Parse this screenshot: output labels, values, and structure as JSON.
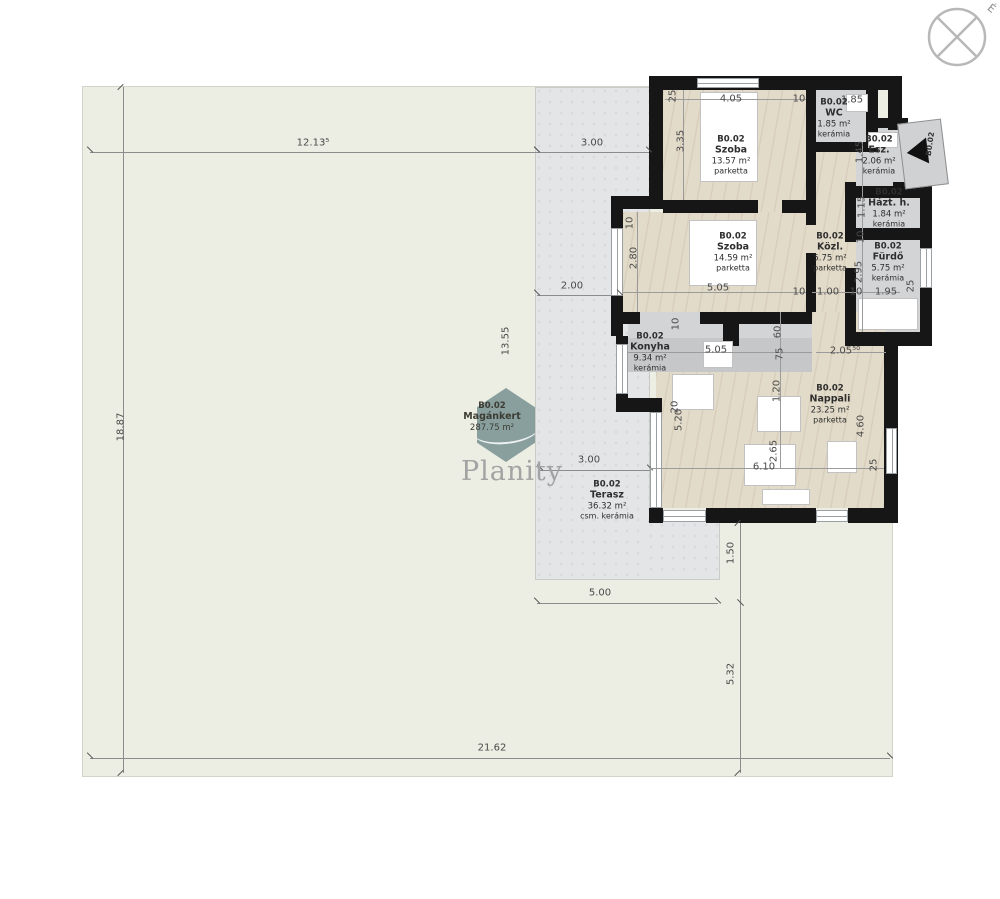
{
  "watermark": {
    "brand": "Planity"
  },
  "compass": {
    "north_label": "É"
  },
  "entrance": {
    "unit_label": "B0.02"
  },
  "colors": {
    "wall": "#161616",
    "parquet_floor": "#e3dbc9",
    "ceramic_floor": "#d3d4d6",
    "terrace": "#e4e5e7",
    "garden": "#ecede3",
    "dimension_text": "#4a4a4a",
    "watermark_hex": "#718d8f"
  },
  "rooms": [
    {
      "id": "szoba-1",
      "unit": "B0.02",
      "name": "Szoba",
      "area": "13.57 m²",
      "material": "parketta",
      "cx": 731,
      "cy": 155
    },
    {
      "id": "wc",
      "unit": "B0.02",
      "name": "WC",
      "area": "1.85 m²",
      "material": "kerámia",
      "cx": 834,
      "cy": 118
    },
    {
      "id": "eloszoba",
      "unit": "B0.02",
      "name": "Esz.",
      "area": "2.06 m²",
      "material": "kerámia",
      "cx": 879,
      "cy": 155
    },
    {
      "id": "haztartasi-helyiseg",
      "unit": "B0.02",
      "name": "Házt. h.",
      "area": "1.84 m²",
      "material": "kerámia",
      "cx": 889,
      "cy": 208
    },
    {
      "id": "furdo",
      "unit": "B0.02",
      "name": "Fürdő",
      "area": "5.75 m²",
      "material": "kerámia",
      "cx": 888,
      "cy": 262
    },
    {
      "id": "kozlekedo",
      "unit": "B0.02",
      "name": "Közl.",
      "area": "5.75 m²",
      "material": "parketta",
      "cx": 830,
      "cy": 252
    },
    {
      "id": "szoba-2",
      "unit": "B0.02",
      "name": "Szoba",
      "area": "14.59 m²",
      "material": "parketta",
      "cx": 733,
      "cy": 252
    },
    {
      "id": "konyha",
      "unit": "B0.02",
      "name": "Konyha",
      "area": "9.34 m²",
      "material": "kerámia",
      "cx": 650,
      "cy": 352
    },
    {
      "id": "nappali",
      "unit": "B0.02",
      "name": "Nappali",
      "area": "23.25 m²",
      "material": "parketta",
      "cx": 830,
      "cy": 404
    },
    {
      "id": "terasz",
      "unit": "B0.02",
      "name": "Terasz",
      "area": "36.32 m²",
      "material": "csm. kerámia",
      "cx": 607,
      "cy": 500
    },
    {
      "id": "magankert",
      "unit": "B0.02",
      "name": "Magánkert",
      "area": "287.75 m²",
      "material": "",
      "cx": 492,
      "cy": 417,
      "garden": true
    }
  ],
  "dimensions": [
    {
      "v": "12.13⁵",
      "x": 313,
      "y": 143,
      "rot": 0
    },
    {
      "v": "3.00",
      "x": 592,
      "y": 143,
      "rot": 0
    },
    {
      "v": "18.87",
      "x": 121,
      "y": 427,
      "rot": -90
    },
    {
      "v": "13.55",
      "x": 506,
      "y": 341,
      "rot": -90
    },
    {
      "v": "2.00",
      "x": 572,
      "y": 286,
      "rot": 0
    },
    {
      "v": "3.00",
      "x": 589,
      "y": 460,
      "rot": 0
    },
    {
      "v": "5.00",
      "x": 600,
      "y": 593,
      "rot": 0
    },
    {
      "v": "21.62",
      "x": 492,
      "y": 748,
      "rot": 0
    },
    {
      "v": "1.50",
      "x": 731,
      "y": 553,
      "rot": -90
    },
    {
      "v": "5.32",
      "x": 731,
      "y": 674,
      "rot": -90
    },
    {
      "v": "25",
      "x": 673,
      "y": 96,
      "rot": -90
    },
    {
      "v": "4.05",
      "x": 731,
      "y": 99,
      "rot": 0
    },
    {
      "v": "10",
      "x": 799,
      "y": 99,
      "rot": 0
    },
    {
      "v": "1.85",
      "x": 852,
      "y": 100,
      "rot": 0
    },
    {
      "v": "3.35",
      "x": 681,
      "y": 141,
      "rot": -90
    },
    {
      "v": "1.45",
      "x": 860,
      "y": 152,
      "rot": -90
    },
    {
      "v": "1.15",
      "x": 862,
      "y": 207,
      "rot": -90
    },
    {
      "v": "10",
      "x": 630,
      "y": 223,
      "rot": -90
    },
    {
      "v": "2.80",
      "x": 634,
      "y": 258,
      "rot": -90
    },
    {
      "v": "5.05",
      "x": 718,
      "y": 288,
      "rot": 0
    },
    {
      "v": "10",
      "x": 799,
      "y": 292,
      "rot": 0
    },
    {
      "v": "1.00",
      "x": 828,
      "y": 292,
      "rot": 0
    },
    {
      "v": "10",
      "x": 856,
      "y": 292,
      "rot": 0
    },
    {
      "v": "1.95",
      "x": 886,
      "y": 292,
      "rot": 0
    },
    {
      "v": "10",
      "x": 861,
      "y": 237,
      "rot": -90
    },
    {
      "v": "2.95",
      "x": 859,
      "y": 272,
      "rot": -90
    },
    {
      "v": "25",
      "x": 911,
      "y": 286,
      "rot": -90
    },
    {
      "v": "10",
      "x": 676,
      "y": 324,
      "rot": -90
    },
    {
      "v": "60",
      "x": 778,
      "y": 332,
      "rot": -90
    },
    {
      "v": "5.05",
      "x": 716,
      "y": 350,
      "rot": 0
    },
    {
      "v": "75",
      "x": 780,
      "y": 354,
      "rot": -90
    },
    {
      "v": "2.05⁵⁰",
      "x": 845,
      "y": 351,
      "rot": 0
    },
    {
      "v": "1.20",
      "x": 777,
      "y": 391,
      "rot": -90
    },
    {
      "v": "20",
      "x": 675,
      "y": 407,
      "rot": -90
    },
    {
      "v": "5.20",
      "x": 679,
      "y": 420,
      "rot": -90
    },
    {
      "v": "4.60",
      "x": 861,
      "y": 426,
      "rot": -90
    },
    {
      "v": "2.65",
      "x": 774,
      "y": 451,
      "rot": -90
    },
    {
      "v": "6.10",
      "x": 764,
      "y": 467,
      "rot": 0
    },
    {
      "v": "25",
      "x": 874,
      "y": 465,
      "rot": -90
    }
  ]
}
